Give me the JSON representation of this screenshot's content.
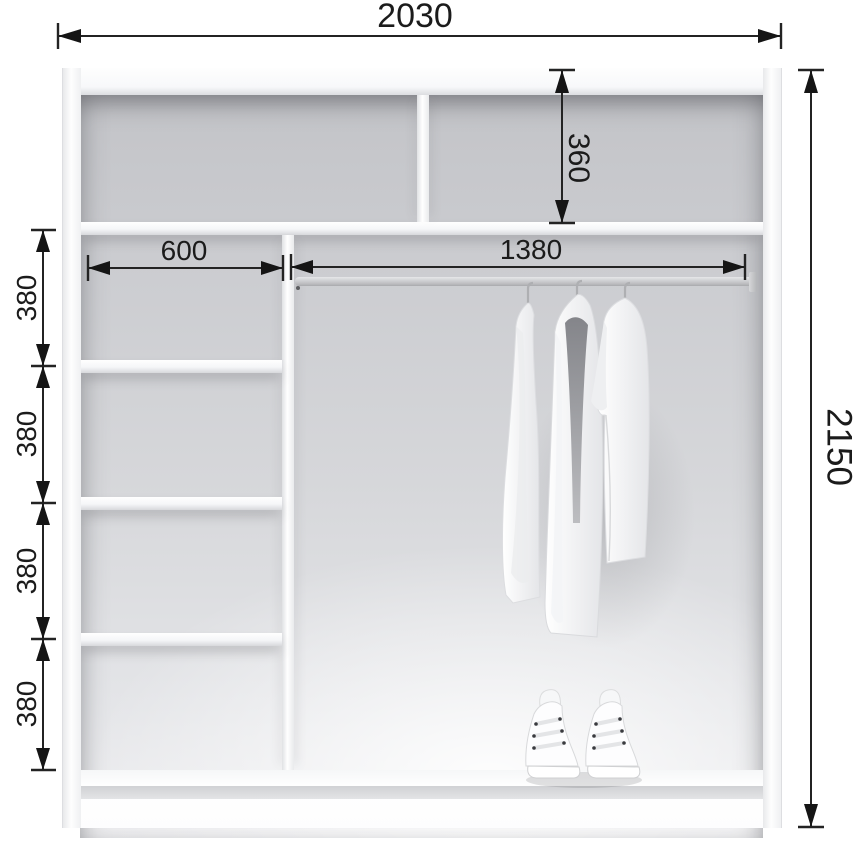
{
  "diagram": {
    "kind": "wardrobe-interior-dimension-drawing",
    "ink_color": "#1b1b1b",
    "panel_color": "#fbfbfd",
    "interior_color": "#d2d3d6",
    "background": "#ffffff"
  },
  "dimensions": {
    "total_width": "2030",
    "total_height": "2150",
    "top_compartment_height": "360",
    "left_column_width": "600",
    "hanging_rod_width": "1380",
    "shelf_spacings": [
      "380",
      "380",
      "380",
      "380"
    ]
  },
  "objects": {
    "clothes": "three-white-shirts-on-hangers",
    "shoes": "pair-of-white-high-top-sneakers"
  }
}
